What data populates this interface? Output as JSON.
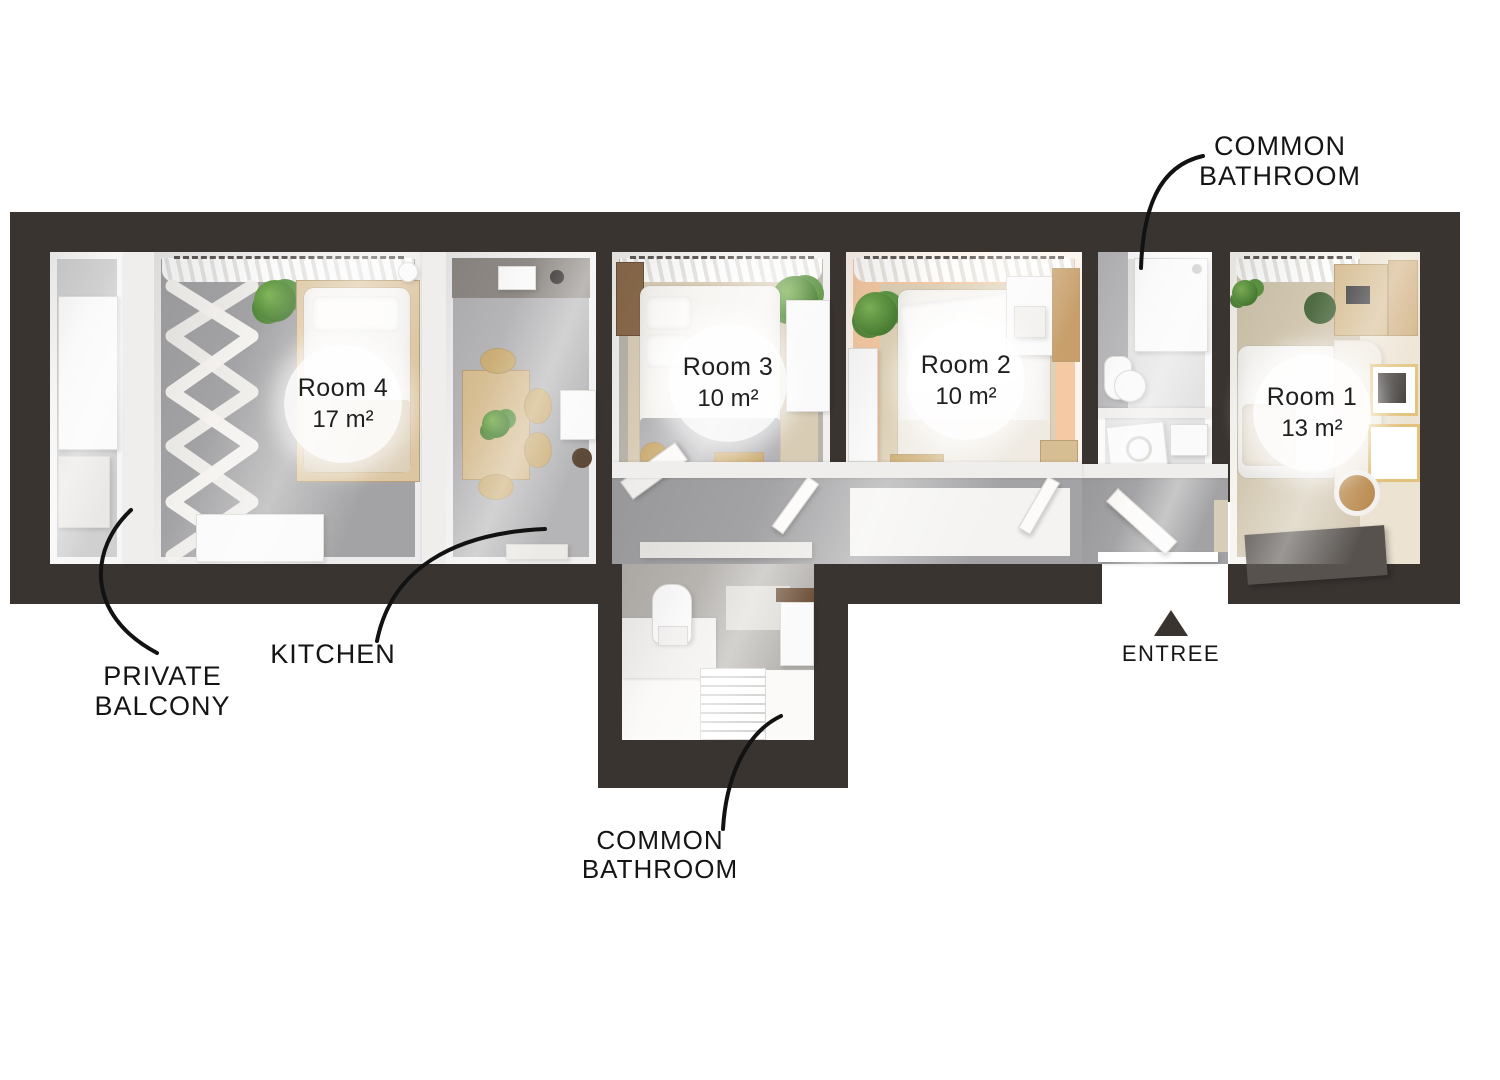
{
  "rooms": {
    "room1": {
      "name": "Room 1",
      "area": "13 m²"
    },
    "room2": {
      "name": "Room 2",
      "area": "10 m²"
    },
    "room3": {
      "name": "Room 3",
      "area": "10 m²"
    },
    "room4": {
      "name": "Room 4",
      "area": "17 m²"
    }
  },
  "annotations": {
    "common_bathroom_top": {
      "line1": "COMMON",
      "line2": "BATHROOM"
    },
    "common_bathroom_bottom": {
      "line1": "COMMON",
      "line2": "BATHROOM"
    },
    "private_balcony": {
      "line1": "PRIVATE",
      "line2": "BALCONY"
    },
    "kitchen": {
      "label": "KITCHEN"
    },
    "entree": {
      "label": "ENTREE"
    }
  },
  "colors": {
    "wall": "#3a3431",
    "background": "#ffffff",
    "floor_gray": "#a3a2a4",
    "floor_tile": "#b5b4b6",
    "carpet_beige": "#d8ccb5",
    "room2_accent": "#f4c9a3",
    "wood_light": "#d6bd92",
    "wood_dark": "#8a6a4c",
    "plant_green": "#5d9040",
    "dark_furniture": "#57524e",
    "label_text": "#151515"
  }
}
